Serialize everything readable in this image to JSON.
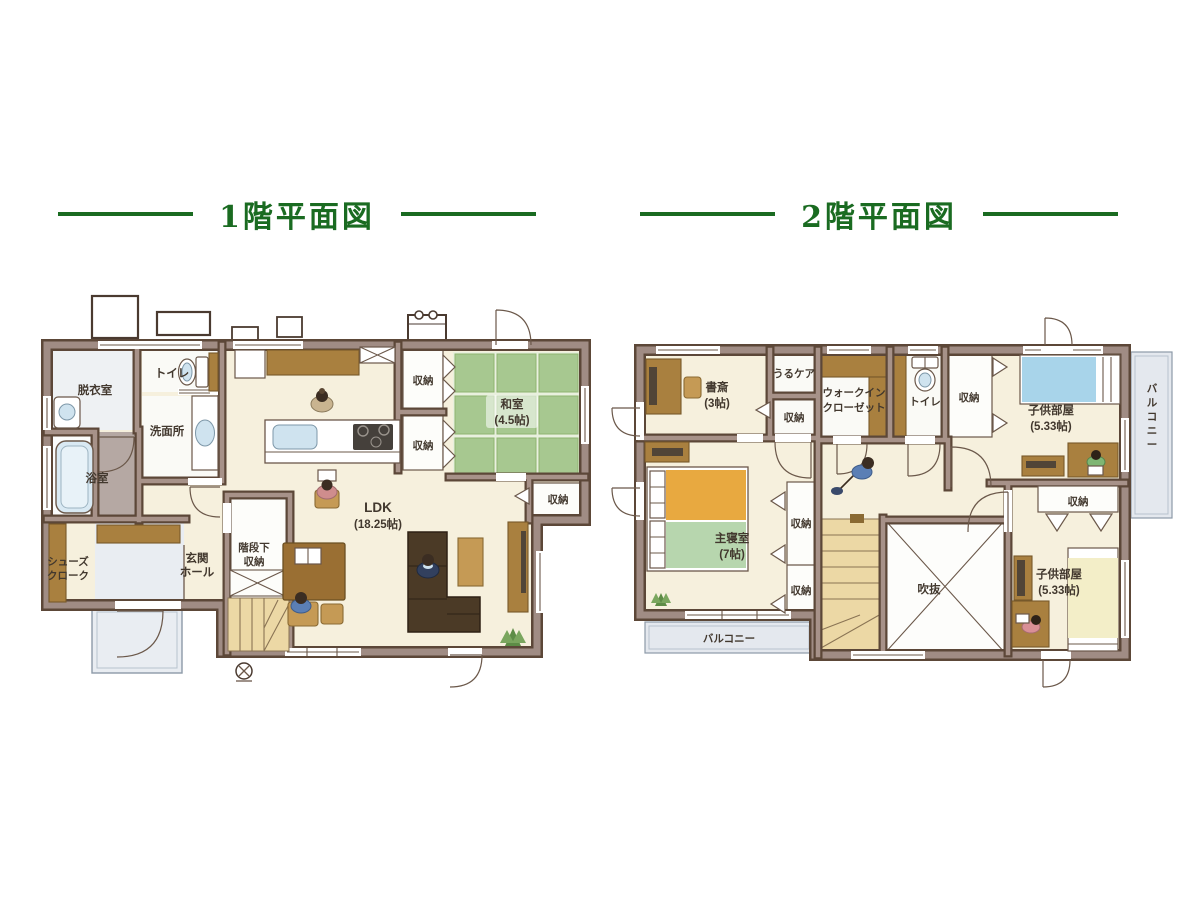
{
  "titles": {
    "floor1": "1階平面図",
    "floor2": "2階平面図"
  },
  "floor1": {
    "rooms": {
      "datsui": "脱衣室",
      "toilet": "トイレ",
      "senmen": "洗面所",
      "bath": "浴室",
      "shoes1": "シューズ",
      "shoes2": "クローク",
      "genkan1": "玄関",
      "genkan2": "ホール",
      "kaidan1": "階段下",
      "kaidan2": "収納",
      "ldk": "LDK",
      "ldk_size": "(18.25帖)",
      "washitsu": "和室",
      "washitsu_size": "(4.5帖)",
      "shuno_a": "収納",
      "shuno_b": "収納",
      "shuno_c": "収納"
    }
  },
  "floor2": {
    "rooms": {
      "shosai": "書斎",
      "shosai_size": "(3帖)",
      "urucare": "うるケア",
      "shuno_a": "収納",
      "wic1": "ウォークイン",
      "wic2": "クローゼット",
      "toilet": "トイレ",
      "shuno_b": "収納",
      "kids1": "子供部屋",
      "kids1_size": "(5.33帖)",
      "balcony_right": "バルコニー",
      "shuno_c": "収納",
      "master": "主寝室",
      "master_size": "(7帖)",
      "shuno_d": "収納",
      "shuno_e": "収納",
      "fukinuke": "吹抜",
      "kids2": "子供部屋",
      "kids2_size": "(5.33帖)",
      "balcony_bottom": "バルコニー"
    }
  },
  "colors": {
    "title_green": "#1a6b21",
    "wall_dark": "#5c4738",
    "wall_light": "#a08c84",
    "floor_cream": "#f6f0dd",
    "tatami_green": "#a7c890",
    "wood_brown": "#a9803f",
    "sofa_brown": "#4b3a26",
    "water_blue": "#cfe3ef",
    "balcony_gray": "#e4e8ee",
    "stair_tan": "#ecd8a5",
    "label_ink": "#42382e"
  }
}
